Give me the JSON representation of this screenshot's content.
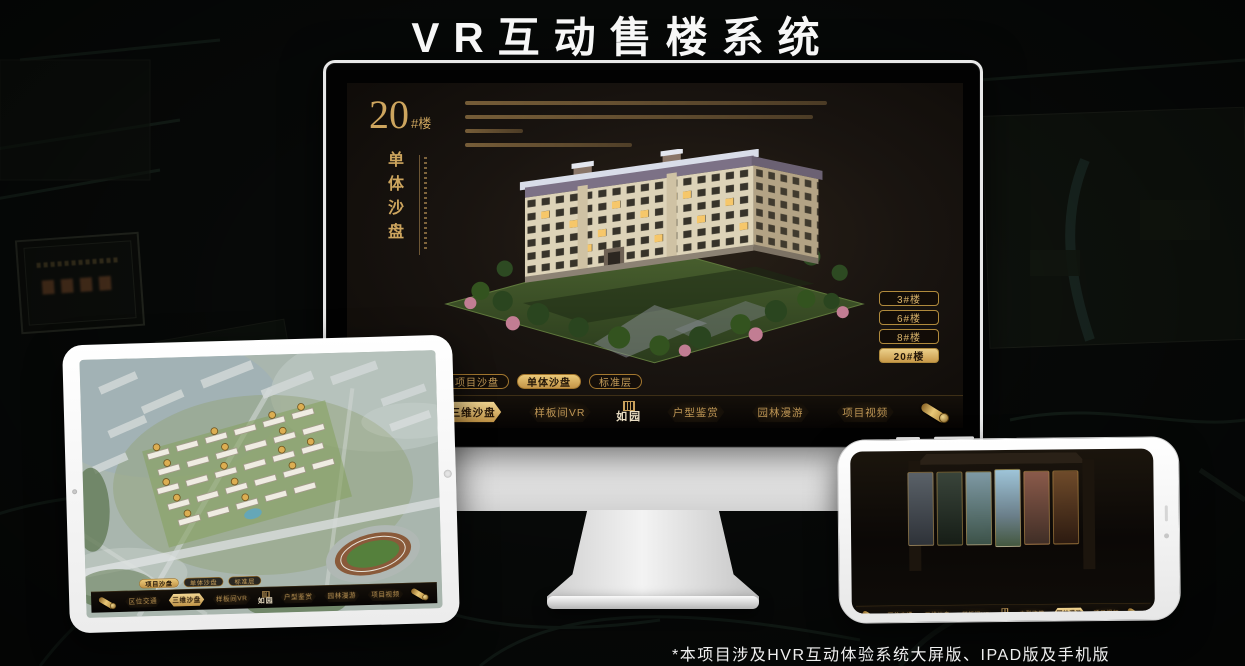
{
  "page": {
    "title": "VR互动售楼系统",
    "footnote": "*本项目涉及HVR互动体验系统大屏版、IPAD版及手机版"
  },
  "brand": {
    "logo_text": "如园",
    "gold": "#c9a263",
    "gold_bright": "#ecd08a",
    "app_background": "#16100a"
  },
  "desktop": {
    "heading_number": "20",
    "heading_unit": "#楼",
    "heading_subtitle": "单体沙盘",
    "floor_buttons": [
      {
        "label": "3#楼",
        "active": false
      },
      {
        "label": "6#楼",
        "active": false
      },
      {
        "label": "8#楼",
        "active": false
      },
      {
        "label": "20#楼",
        "active": true
      }
    ],
    "tabs": [
      {
        "label": "项目沙盘",
        "active": false
      },
      {
        "label": "单体沙盘",
        "active": true
      },
      {
        "label": "标准层",
        "active": false
      }
    ],
    "menu": [
      {
        "label": "区位交通",
        "active": false
      },
      {
        "label": "三维沙盘",
        "active": true
      },
      {
        "label": "样板间VR",
        "active": false
      },
      {
        "label": "户型鉴赏",
        "active": false
      },
      {
        "label": "园林漫游",
        "active": false
      },
      {
        "label": "项目视频",
        "active": false
      }
    ]
  },
  "tablet": {
    "tabs": [
      {
        "label": "项目沙盘",
        "active": true
      },
      {
        "label": "单体沙盘",
        "active": false
      },
      {
        "label": "标准层",
        "active": false
      }
    ],
    "menu": [
      {
        "label": "区位交通",
        "active": false
      },
      {
        "label": "三维沙盘",
        "active": true
      },
      {
        "label": "样板间VR",
        "active": false
      },
      {
        "label": "户型鉴赏",
        "active": false
      },
      {
        "label": "园林漫游",
        "active": false
      },
      {
        "label": "项目视频",
        "active": false
      }
    ]
  },
  "phone": {
    "menu": [
      {
        "label": "区位交通",
        "active": false
      },
      {
        "label": "三维沙盘",
        "active": false
      },
      {
        "label": "样板间VR",
        "active": false
      },
      {
        "label": "户型鉴赏",
        "active": false
      },
      {
        "label": "园林漫游",
        "active": true
      },
      {
        "label": "项目视频",
        "active": false
      }
    ]
  }
}
